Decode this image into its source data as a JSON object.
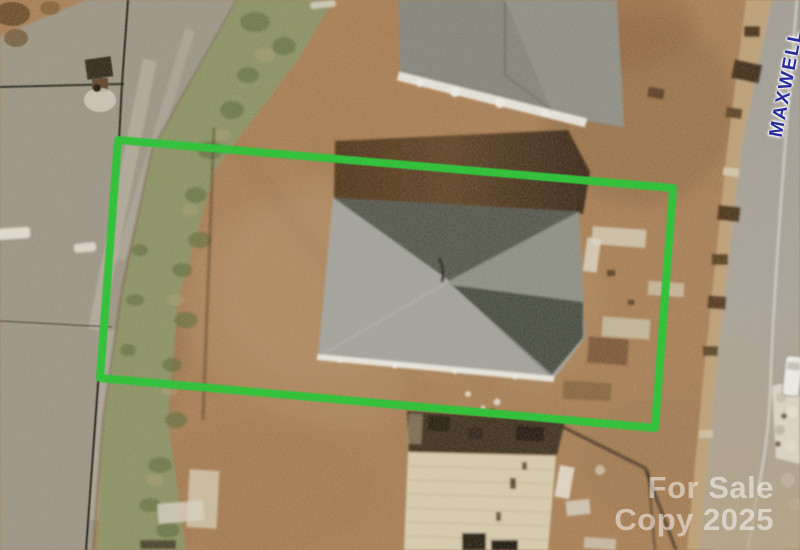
{
  "map": {
    "street_label": {
      "text": "MAXWELL"
    },
    "watermark": {
      "line1": "For Sale",
      "line2": "Copy 2025"
    },
    "property_boundary": {
      "shape": "rotated-rectangle"
    },
    "features": [
      "main-house-hip-roof",
      "neighbor-house-roof",
      "construction-subfloor",
      "asphalt-road",
      "gravel-path",
      "grass-strip",
      "utility-lines",
      "utility-pole",
      "white-vehicle",
      "materials-pile"
    ]
  },
  "colors": {
    "boundary_green": "#20c22d",
    "street_label_blue": "#2b2c9c",
    "watermark_white": "rgba(255,255,255,0.5)",
    "dirt_brown": "#a87e53",
    "roof_gray": "#a3a39b",
    "road_gray": "#a6a198",
    "grass_green": "#8b9164",
    "path_gray": "#9c9585"
  }
}
